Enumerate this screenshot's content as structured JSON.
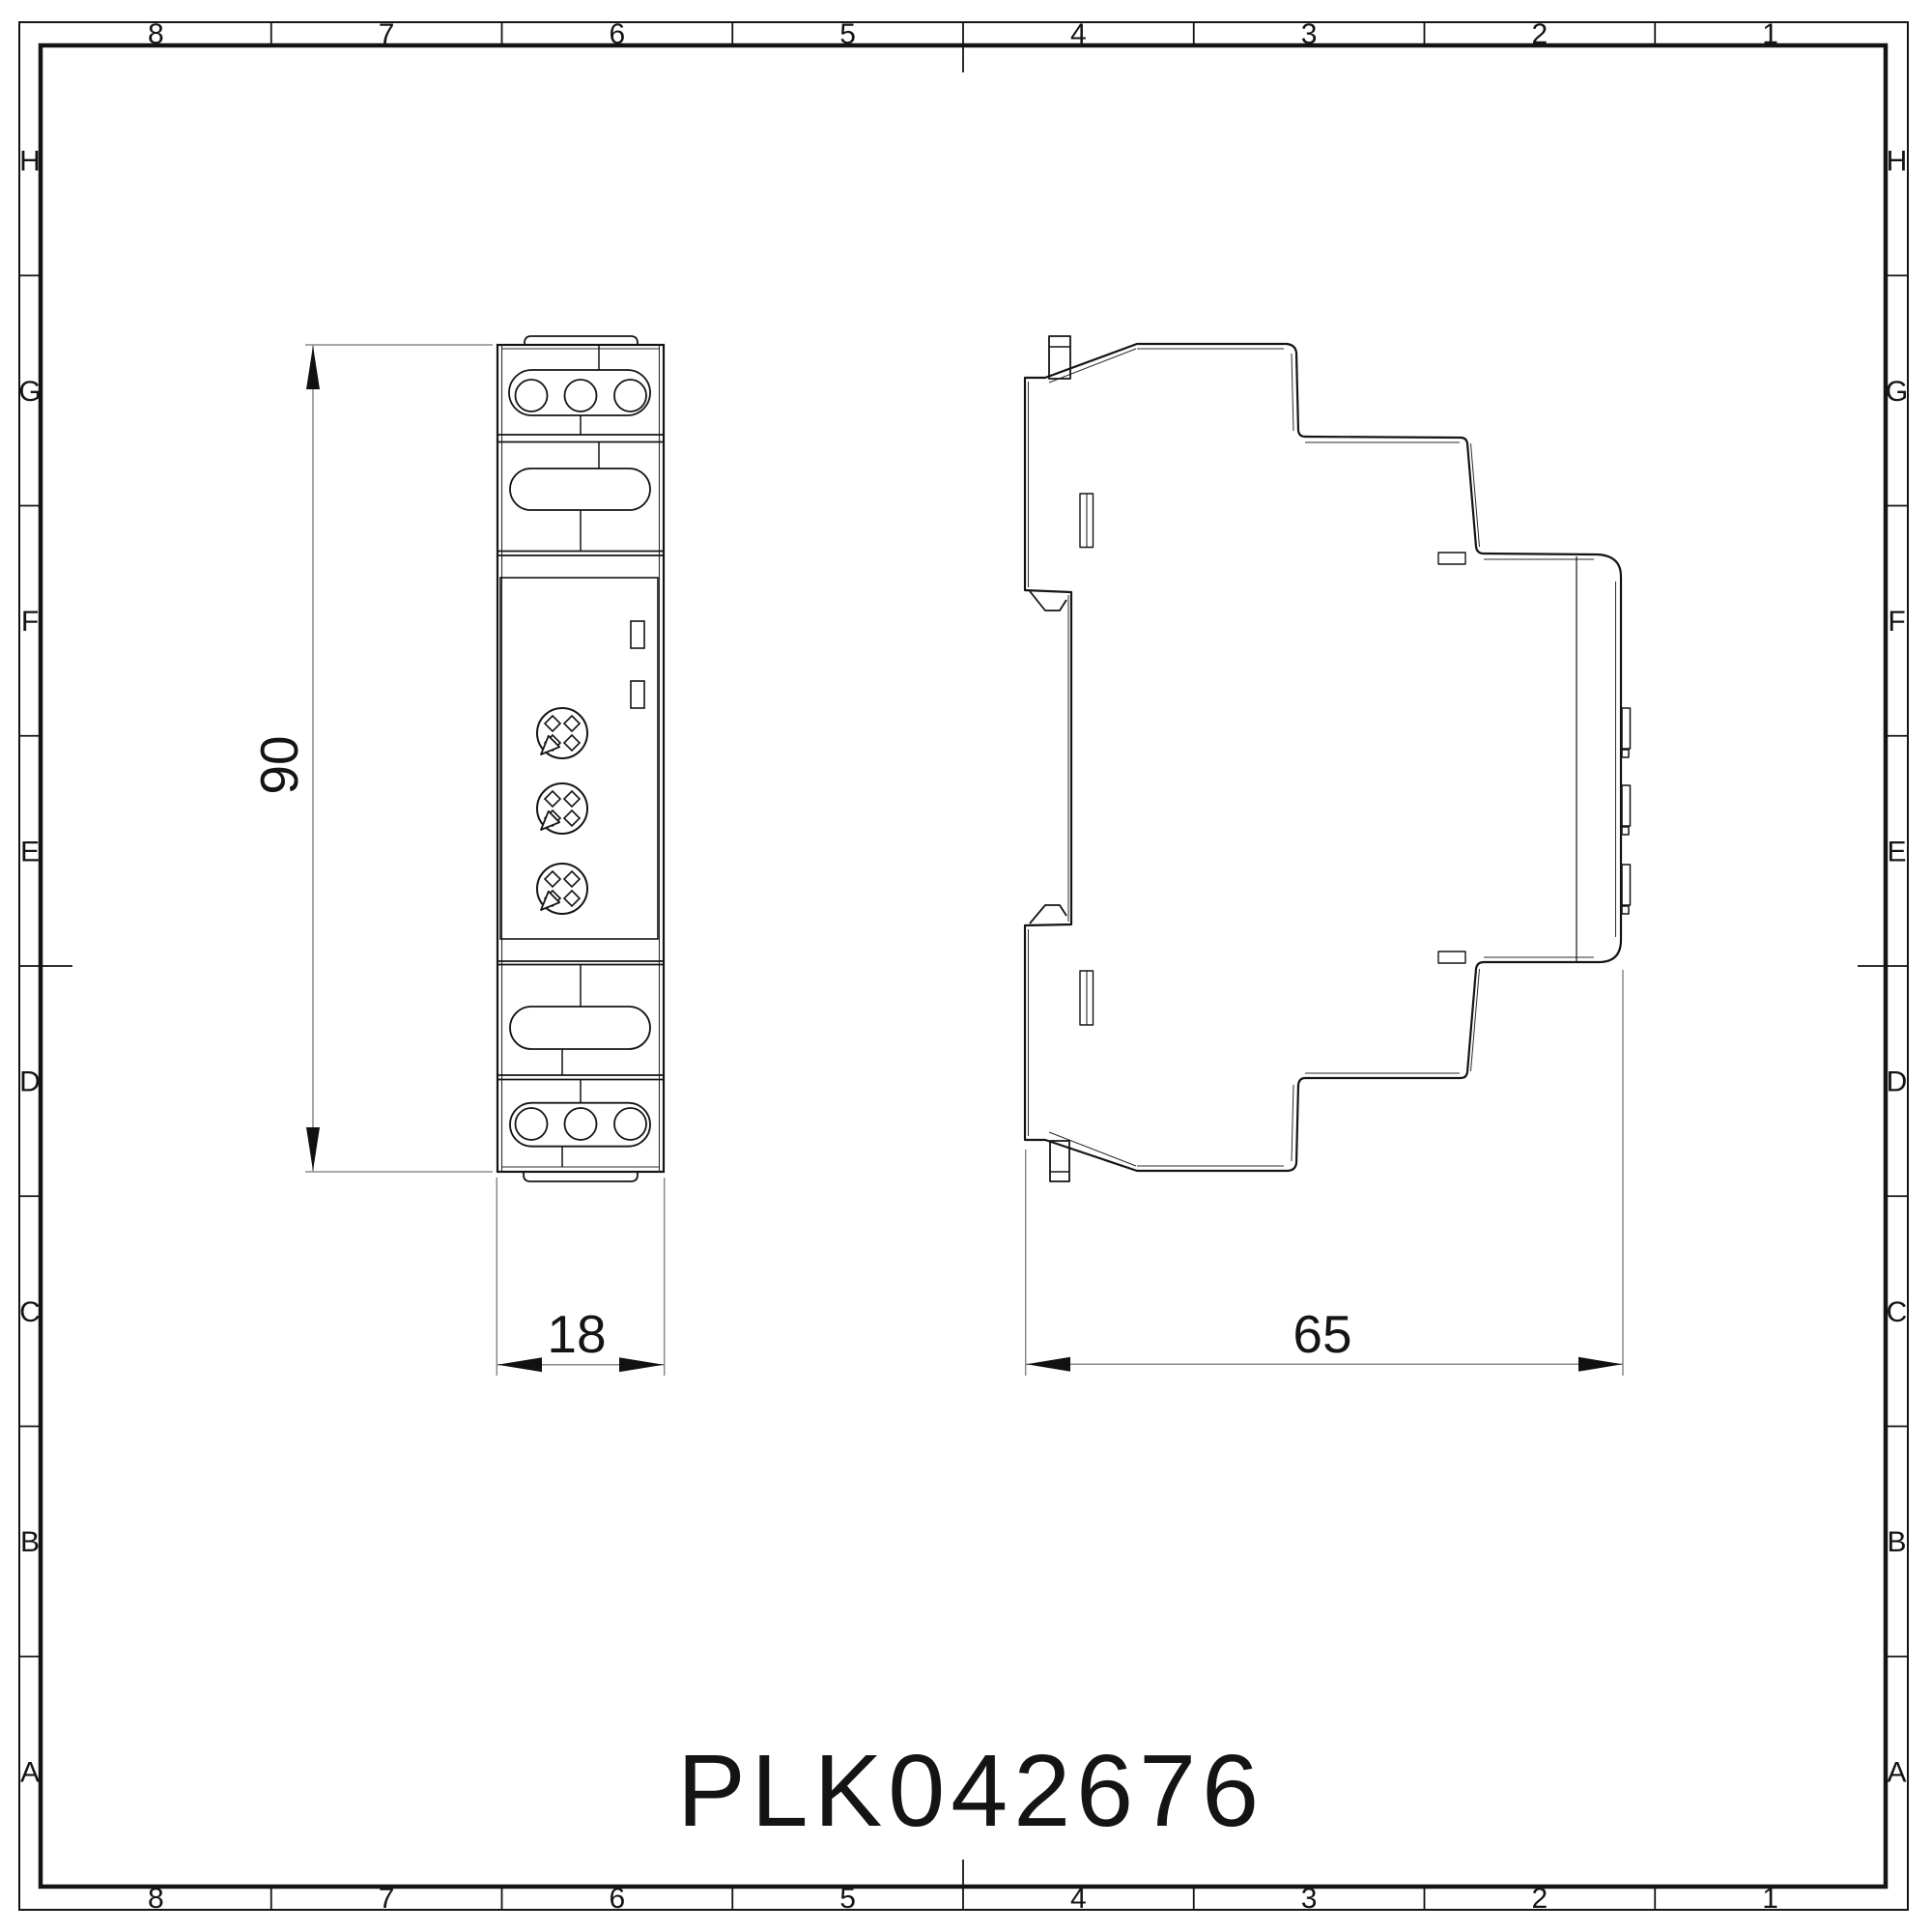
{
  "drawing": {
    "part_number": "PLK042676",
    "frame": {
      "columns": [
        "8",
        "7",
        "6",
        "5",
        "4",
        "3",
        "2",
        "1"
      ],
      "rows": [
        "H",
        "G",
        "F",
        "E",
        "D",
        "C",
        "B",
        "A"
      ]
    },
    "dimensions": {
      "height": "90",
      "width": "18",
      "depth": "65"
    },
    "views": {
      "front_label": "front view of DIN-rail module",
      "side_label": "side view of DIN-rail module"
    },
    "colors": {
      "outline": "#141414",
      "thin": "#2a2a2a",
      "dim": "#8a8a8a",
      "arrow": "#111111",
      "background": "#ffffff"
    }
  }
}
